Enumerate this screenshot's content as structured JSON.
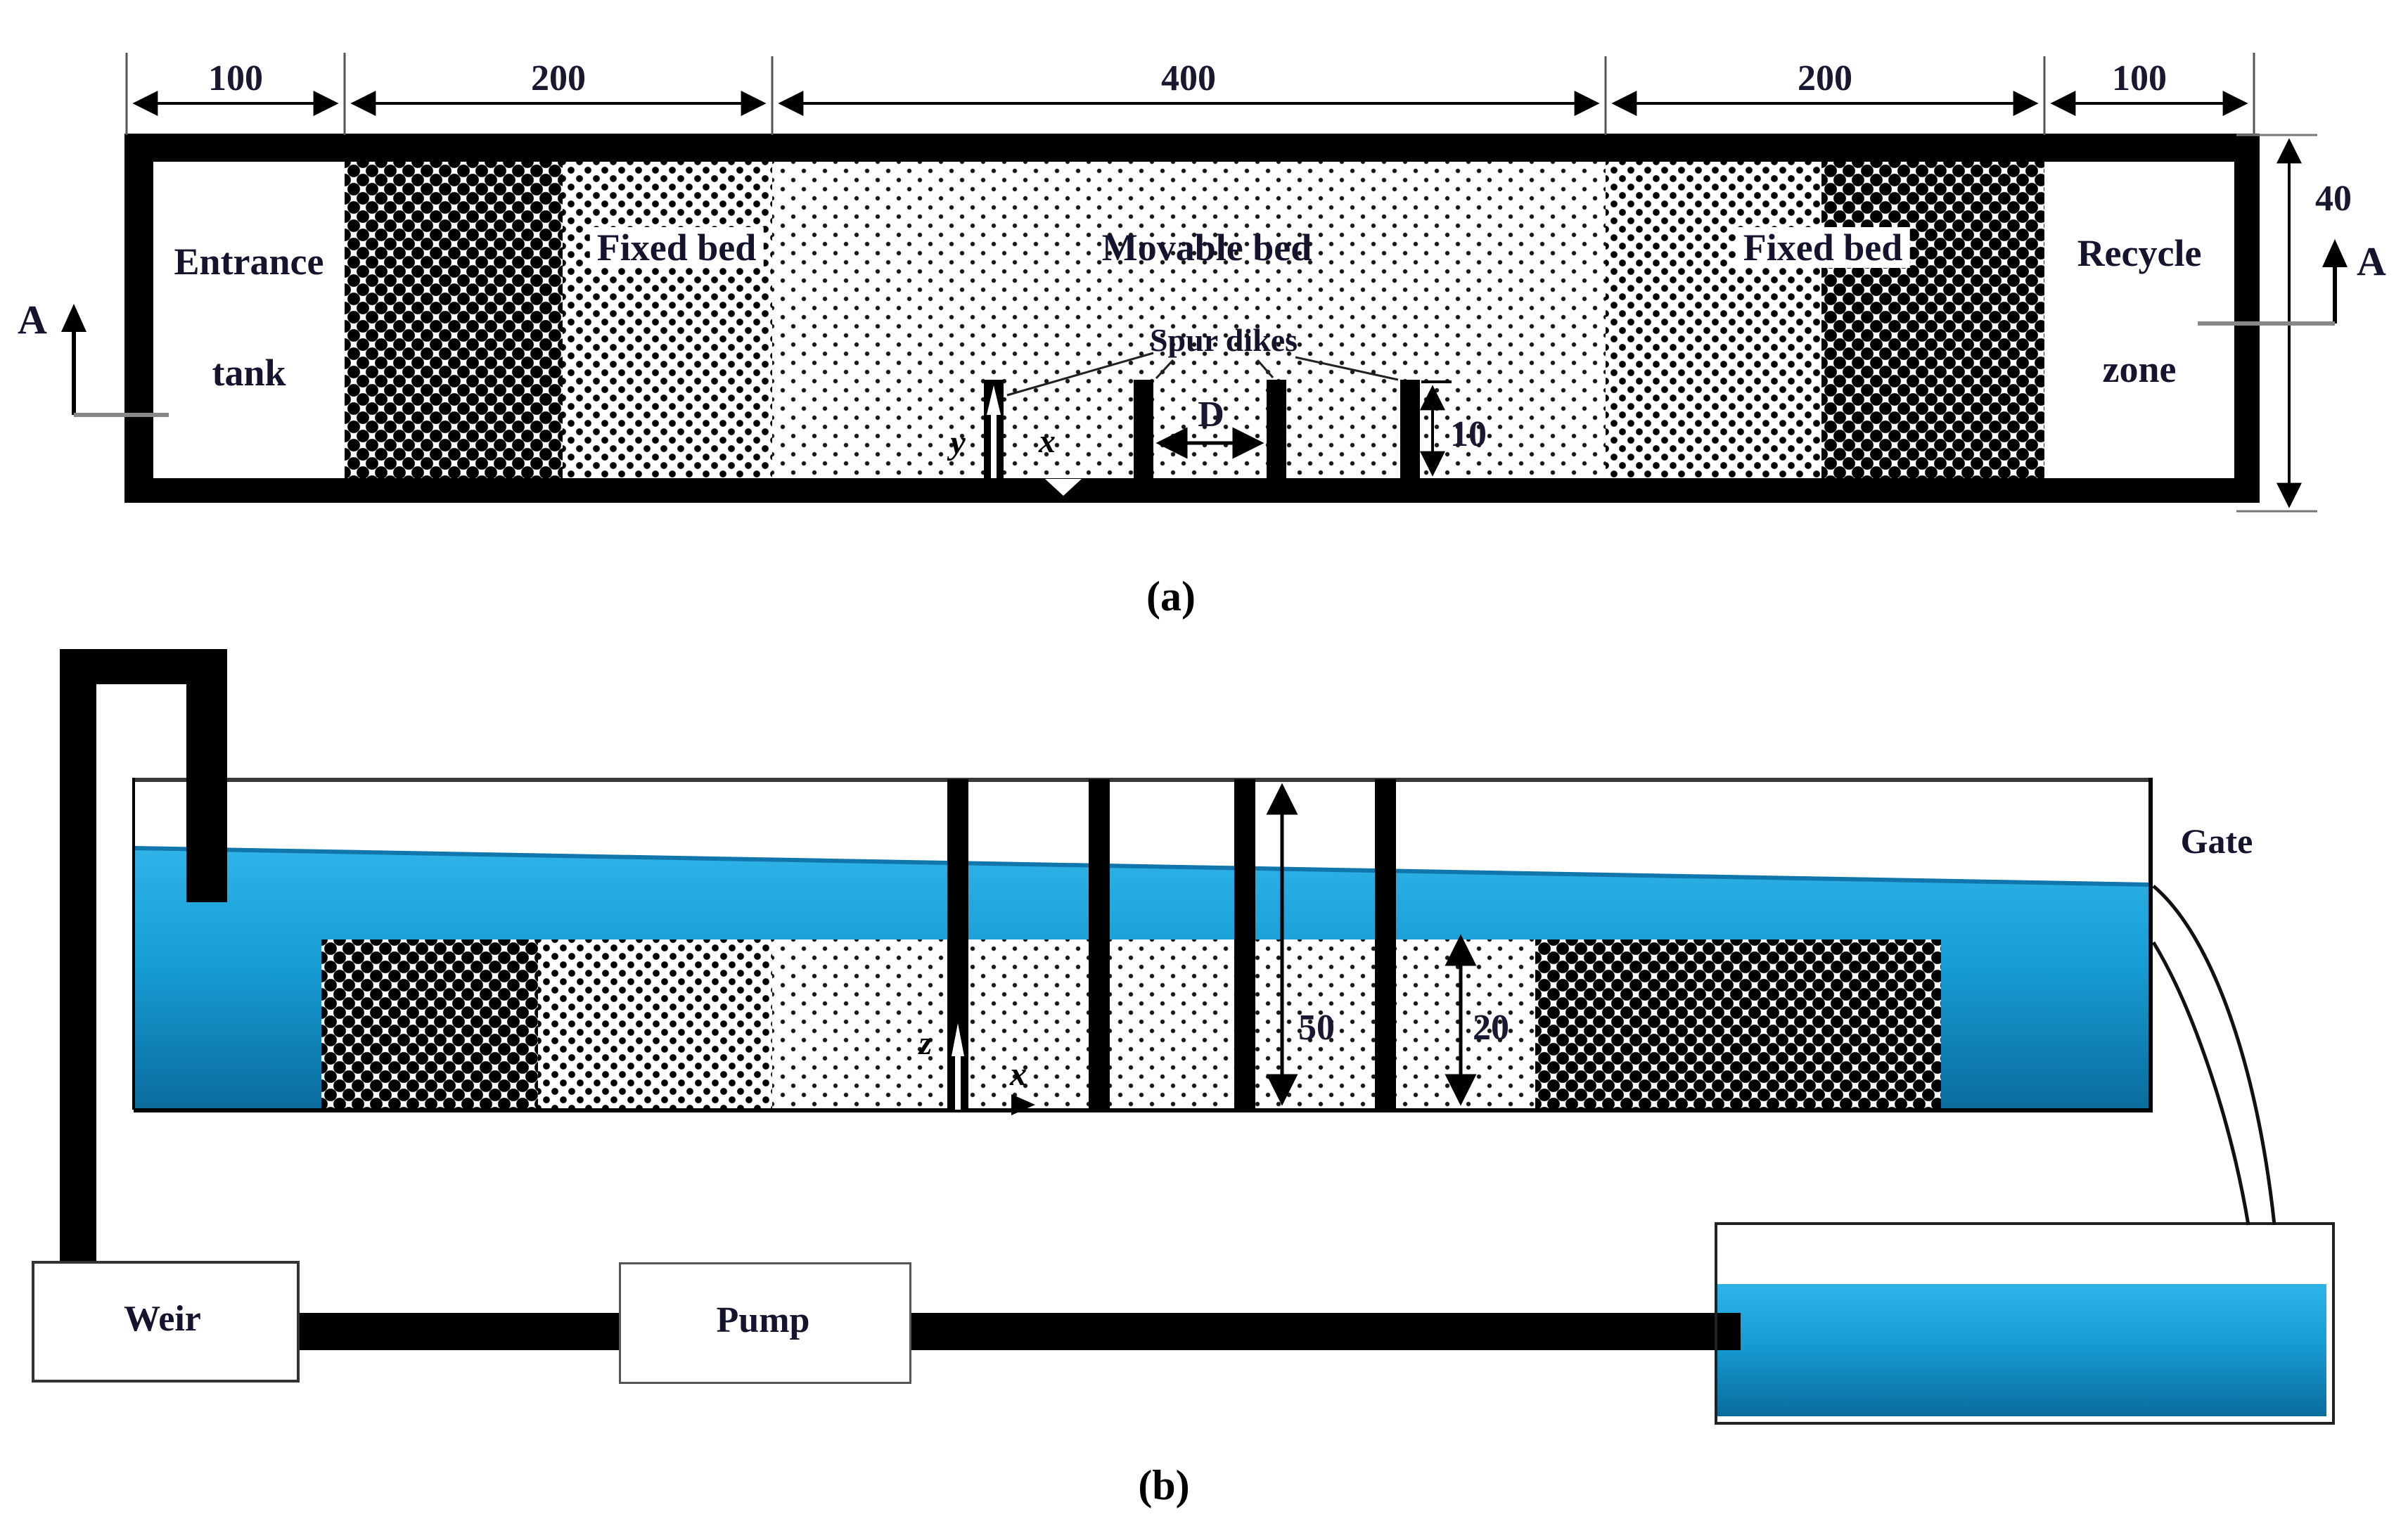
{
  "figure": {
    "type": "experimental-flume-schematic",
    "colors": {
      "water_top": "#2fb3e8",
      "water_mid": "#179cd4",
      "water_bottom": "#0a6c9d",
      "wall_black": "#000000",
      "marker_gray": "#888888",
      "text_dark": "#14142e"
    },
    "panel_a": {
      "caption": "(a)",
      "view": "plan view",
      "dimensions_top": [
        "100",
        "200",
        "400",
        "200",
        "100"
      ],
      "flume_width_dim": "40",
      "zones": {
        "entrance_line1": "Entrance",
        "entrance_line2": "tank",
        "fixed_bed_left": "Fixed bed",
        "movable_bed": "Movable bed",
        "fixed_bed_right": "Fixed bed",
        "recycle_line1": "Recycle",
        "recycle_line2": "zone"
      },
      "spur_dikes_label": "Spur dikes",
      "spur_dike_count": 4,
      "dike_spacing_dim": "D",
      "dike_length_dim": "10",
      "axes": {
        "x": "x",
        "y": "y"
      },
      "section_marker": "A"
    },
    "panel_b": {
      "caption": "(b)",
      "view": "side view",
      "gate_label": "Gate",
      "weir_label": "Weir",
      "pump_label": "Pump",
      "flume_depth_dim": "50",
      "bed_thickness_dim": "20",
      "axes": {
        "x": "x",
        "z": "z"
      },
      "spur_dike_count": 4
    }
  }
}
